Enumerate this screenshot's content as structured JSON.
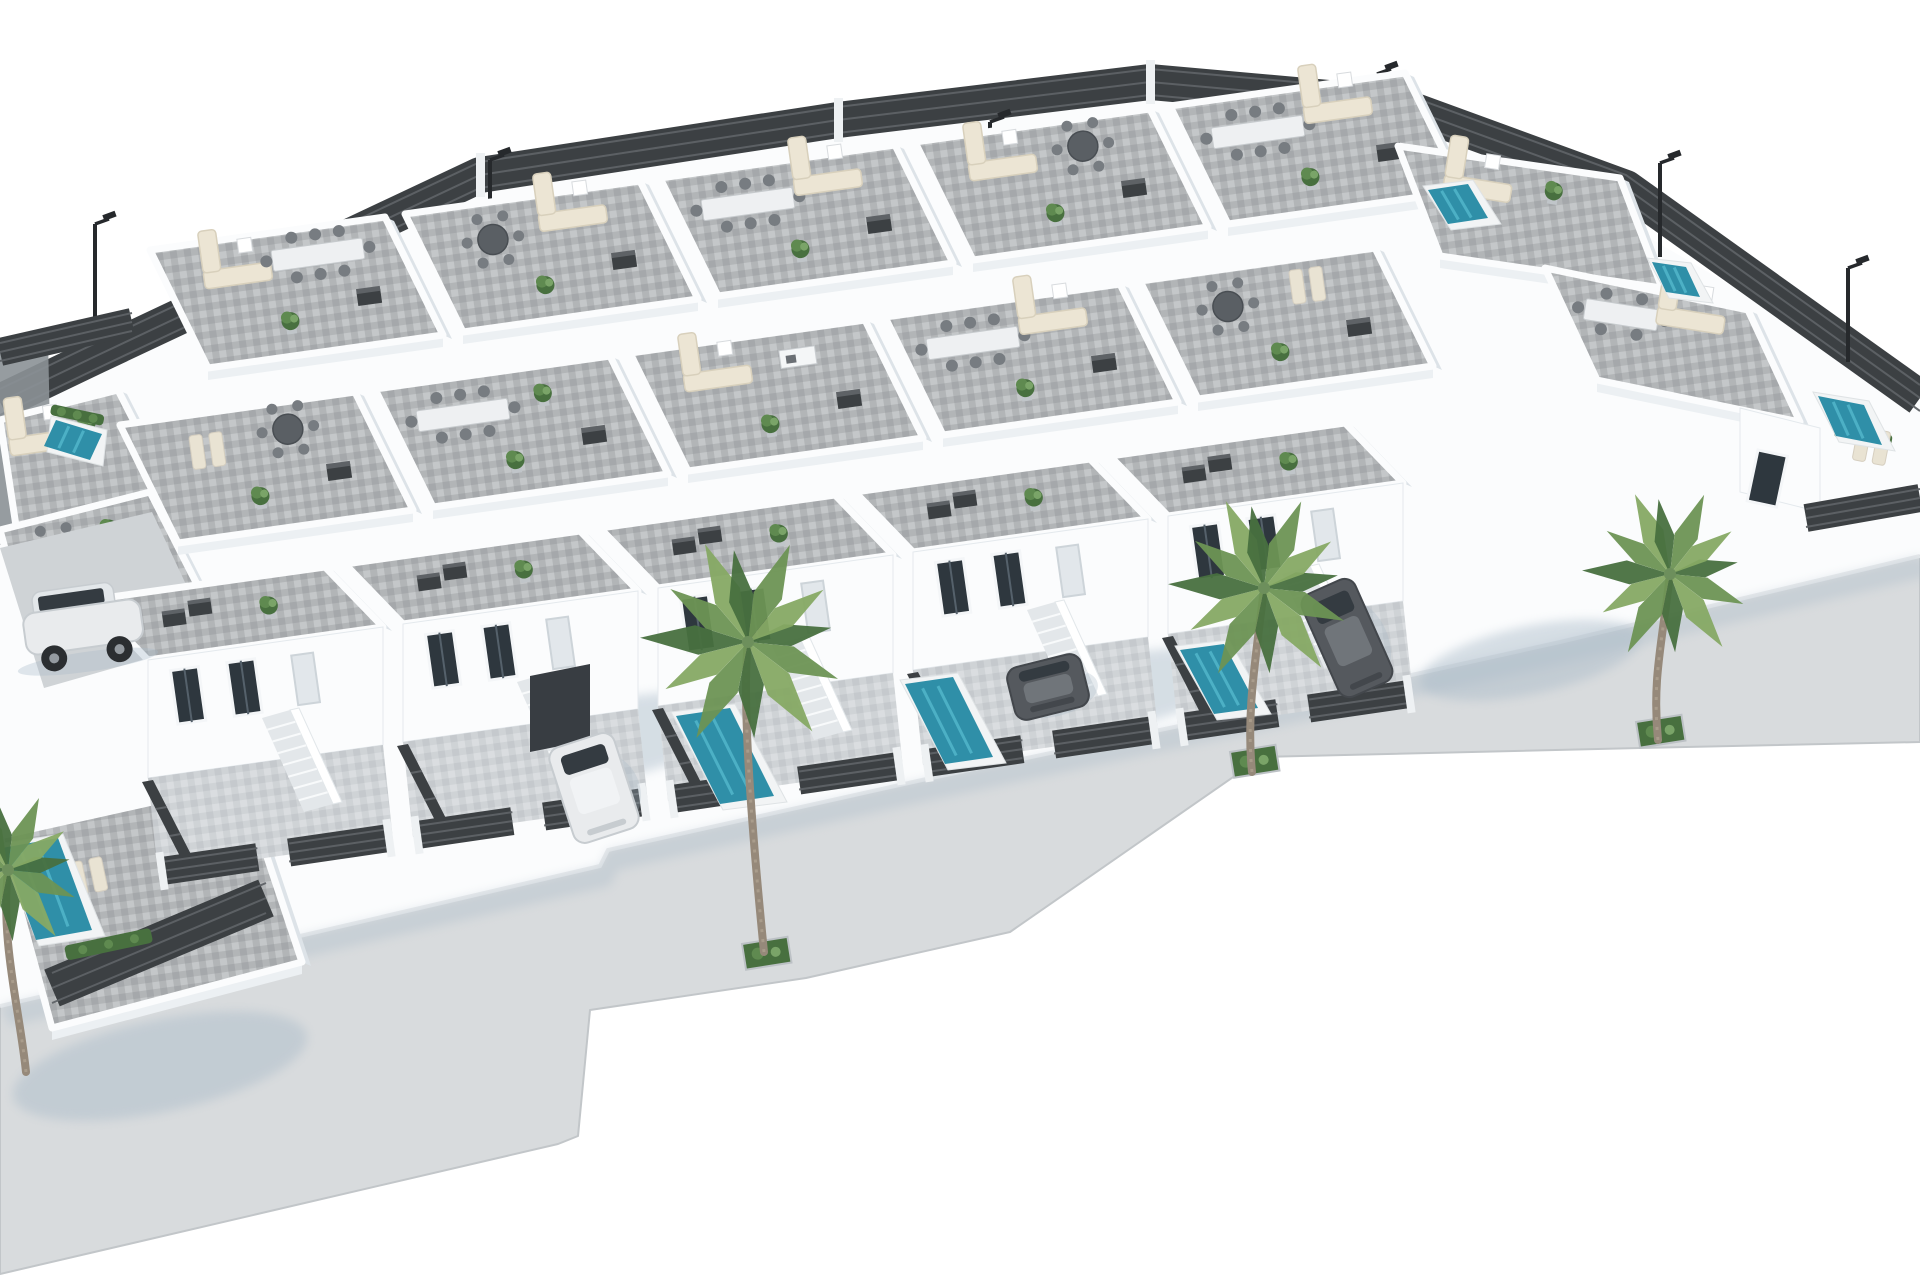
{
  "meta": {
    "description": "Aerial 3D architectural rendering of a modern white villa development: rows of flat-roof townhouse villas with grey tiled rooftop terraces furnished with sofas and dining sets, private front yards with small teal swimming pools, dark slatted perimeter fences, street lamps, parked cars and palm trees along a light grey sidewalk on white ground."
  },
  "palette": {
    "bg": "#ffffff",
    "wall": "#fbfcfd",
    "wall_shade": "#ecf0f3",
    "wall_shade2": "#dde3e8",
    "wall_dark": "#8b9196",
    "roof_base": "#b2b5b7",
    "roof_light": "#c4c7c9",
    "roof_dark": "#a0a3a5",
    "pavement": "#d8dbdd",
    "pavement_dark": "#cfd3d6",
    "curb": "#c2c6c9",
    "yard": "#cfd3d6",
    "yard_light": "#dde0e3",
    "fence": "#3c4043",
    "fence_slat": "#5e6266",
    "fence_post": "#eef1f3",
    "pool_rim": "#f2f4f5",
    "water": "#2f8fa8",
    "water_light": "#52b6cb",
    "plant_dark": "#48703f",
    "plant": "#5f8a50",
    "plant_light": "#7aa468",
    "palm_1": "#6d9454",
    "palm_2": "#86a964",
    "palm_trunk": "#96897a",
    "lounger": "#e9e3d3",
    "sofa": "#ece5d4",
    "sofa_edge": "#d8d0bc",
    "table_white": "#eef0f2",
    "table_dark": "#5a5f64",
    "chair": "#777c81",
    "car_white": "#e9ebed",
    "car_dark": "#55595e",
    "car_glass": "#343b41",
    "shadow": "#a9bac8",
    "lamp": "#26292c"
  },
  "scene": {
    "canvas": {
      "w": 1920,
      "h": 1280
    },
    "hull": [
      [
        0,
        420
      ],
      [
        96,
        350
      ],
      [
        480,
        168
      ],
      [
        1150,
        70
      ],
      [
        1400,
        92
      ],
      [
        1920,
        396
      ],
      [
        1920,
        560
      ],
      [
        1560,
        648
      ],
      [
        1236,
        722
      ],
      [
        922,
        782
      ],
      [
        600,
        864
      ],
      [
        0,
        1006
      ]
    ],
    "sidewalk": {
      "outline": [
        [
          0,
          1006
        ],
        [
          600,
          866
        ],
        [
          608,
          850
        ],
        [
          922,
          780
        ],
        [
          1236,
          714
        ],
        [
          1560,
          642
        ],
        [
          1920,
          556
        ],
        [
          1920,
          742
        ],
        [
          1640,
          748
        ],
        [
          1262,
          757
        ],
        [
          1010,
          932
        ],
        [
          806,
          978
        ],
        [
          590,
          1010
        ],
        [
          578,
          1136
        ],
        [
          558,
          1144
        ],
        [
          0,
          1274
        ]
      ],
      "upper_edge": [
        [
          0,
          1006
        ],
        [
          600,
          866
        ],
        [
          608,
          850
        ],
        [
          922,
          780
        ],
        [
          1236,
          714
        ],
        [
          1560,
          642
        ],
        [
          1920,
          556
        ]
      ]
    },
    "back_fence": {
      "points": [
        [
          0,
          402
        ],
        [
          96,
          356
        ],
        [
          480,
          175
        ],
        [
          838,
          120
        ],
        [
          1150,
          82
        ],
        [
          1396,
          104
        ],
        [
          1626,
          188
        ],
        [
          1920,
          398
        ]
      ],
      "width": 36,
      "posts": [
        [
          480,
          175
        ],
        [
          838,
          120
        ],
        [
          1150,
          82
        ],
        [
          1396,
          104
        ]
      ]
    },
    "grid": {
      "origin": [
        150,
        250
      ],
      "step_col": [
        255,
        -36
      ],
      "step_row": [
        -30,
        175
      ],
      "rows": 3,
      "cols": 5,
      "roof_a": [
        235,
        -33
      ],
      "roof_b": [
        58,
        118
      ],
      "roof_b_front": [
        58,
        60
      ],
      "facade_h": 118,
      "yard_d": 95
    },
    "roof_items": [
      [
        [
          "sofaL",
          "dining8",
          "plant",
          "ac"
        ],
        [
          "round6",
          "sofaL",
          "plant",
          "ac"
        ],
        [
          "dining8",
          "sofaL",
          "plant",
          "ac"
        ],
        [
          "sofaL",
          "round6",
          "plant",
          "ac"
        ],
        [
          "dining8",
          "sofaL",
          "plant",
          "ac"
        ]
      ],
      [
        [
          "loungers",
          "round6",
          "plant",
          "ac"
        ],
        [
          "dining8",
          "plant",
          "plant",
          "ac"
        ],
        [
          "sofaL",
          "kitchen",
          "plant",
          "ac"
        ],
        [
          "dining8",
          "sofaL",
          "plant",
          "ac"
        ],
        [
          "round6",
          "loungers",
          "plant",
          "ac"
        ]
      ]
    ],
    "front_roof_items": [
      "chimney",
      "plant"
    ],
    "left_wing": {
      "wall_strip": [
        [
          0,
          350
        ],
        [
          48,
          338
        ],
        [
          52,
          530
        ],
        [
          0,
          545
        ]
      ],
      "terraces": [
        {
          "quad": [
            [
              0,
              420
            ],
            [
              118,
              390
            ],
            [
              170,
              492
            ],
            [
              16,
              526
            ]
          ],
          "items": [
            "sofaL",
            "plant"
          ]
        },
        {
          "quad": [
            [
              0,
              530
            ],
            [
              150,
              492
            ],
            [
              204,
              598
            ],
            [
              30,
              640
            ]
          ],
          "items": [
            "round6",
            "plant"
          ]
        }
      ],
      "driveway": [
        [
          0,
          548
        ],
        [
          152,
          512
        ],
        [
          212,
          640
        ],
        [
          44,
          688
        ]
      ],
      "corner_terrace": {
        "quad": [
          [
            0,
            836
          ],
          [
            242,
            782
          ],
          [
            302,
            962
          ],
          [
            52,
            1028
          ]
        ],
        "items": [
          "loungers",
          "plant"
        ]
      },
      "fences": [
        {
          "pts": [
            [
              0,
              352
            ],
            [
              132,
              322
            ]
          ],
          "w": 28
        },
        {
          "pts": [
            [
              52,
              988
            ],
            [
              266,
              898
            ]
          ],
          "w": 40
        }
      ],
      "hedges": [
        [
          52,
          404,
          54,
          11,
          12
        ],
        [
          64,
          946,
          88,
          15,
          -12
        ]
      ]
    },
    "right_wing": {
      "roofs": [
        {
          "quad": [
            [
              1398,
              146
            ],
            [
              1620,
              178
            ],
            [
              1662,
              288
            ],
            [
              1440,
              256
            ]
          ],
          "items": [
            "sofaL",
            "plant"
          ]
        },
        {
          "quad": [
            [
              1545,
              268
            ],
            [
              1748,
              310
            ],
            [
              1800,
              422
            ],
            [
              1597,
              380
            ]
          ],
          "items": [
            "dining6",
            "sofaL"
          ]
        }
      ],
      "wall": [
        [
          1740,
          408
        ],
        [
          1820,
          428
        ],
        [
          1820,
          512
        ],
        [
          1740,
          492
        ]
      ],
      "door": [
        1758,
        450,
        30,
        52,
        12
      ],
      "front_fence": {
        "pts": [
          [
            1806,
            518
          ],
          [
            1920,
            498
          ]
        ],
        "w": 28
      },
      "hedges": [
        [
          1836,
          424,
          58,
          13,
          11
        ]
      ],
      "loungers": [
        1872,
        446,
        11
      ]
    },
    "pools": [
      {
        "q": [
          676,
          716
        ],
        "a": [
          54,
          -8
        ],
        "b": [
          44,
          88
        ]
      },
      {
        "q": [
          905,
          684
        ],
        "a": [
          48,
          -7
        ],
        "b": [
          40,
          80
        ]
      },
      {
        "q": [
          1180,
          650
        ],
        "a": [
          44,
          -6
        ],
        "b": [
          34,
          64
        ]
      },
      {
        "q": [
          1428,
          190
        ],
        "a": [
          40,
          -6
        ],
        "b": [
          20,
          34
        ]
      },
      {
        "q": [
          1652,
          262
        ],
        "a": [
          34,
          5
        ],
        "b": [
          14,
          30
        ]
      },
      {
        "q": [
          1818,
          396
        ],
        "a": [
          46,
          9
        ],
        "b": [
          18,
          40
        ]
      },
      {
        "q": [
          56,
          420
        ],
        "a": [
          46,
          14
        ],
        "b": [
          -12,
          26
        ]
      },
      {
        "q": [
          2,
          848
        ],
        "a": [
          56,
          -10
        ],
        "b": [
          34,
          92
        ]
      }
    ],
    "garage": [
      [
        530,
        676
      ],
      [
        590,
        664
      ],
      [
        590,
        740
      ],
      [
        530,
        752
      ]
    ],
    "cars": [
      {
        "type": "suv",
        "color": "white",
        "x": 24,
        "y": 584,
        "w": 118,
        "h": 84,
        "rot": -8
      },
      {
        "type": "top",
        "color": "white",
        "x": 560,
        "y": 738,
        "w": 68,
        "h": 100,
        "rot": -18
      },
      {
        "type": "top",
        "color": "dark",
        "x": 1010,
        "y": 660,
        "w": 76,
        "h": 54,
        "rot": -14
      },
      {
        "type": "top",
        "color": "dark",
        "x": 1318,
        "y": 582,
        "w": 58,
        "h": 112,
        "rot": -24
      }
    ],
    "palms": [
      {
        "crown": [
          748,
          642
        ],
        "r": 108,
        "base": [
          764,
          952
        ]
      },
      {
        "crown": [
          1264,
          588
        ],
        "r": 96,
        "base": [
          1252,
          772
        ]
      },
      {
        "crown": [
          1670,
          574
        ],
        "r": 88,
        "base": [
          1658,
          740
        ]
      },
      {
        "crown": [
          8,
          870
        ],
        "r": 80,
        "base": [
          26,
          1072
        ]
      }
    ],
    "planters": [
      [
        742,
        944
      ],
      [
        1230,
        752
      ],
      [
        1636,
        722
      ]
    ],
    "shadows": [
      {
        "c": [
          600,
          742
        ],
        "rx": 148,
        "ry": 40,
        "rot": -12
      },
      {
        "c": [
          1118,
          692
        ],
        "rx": 126,
        "ry": 36,
        "rot": -12
      },
      {
        "c": [
          1530,
          660
        ],
        "rx": 112,
        "ry": 34,
        "rot": -12
      },
      {
        "c": [
          160,
          1066
        ],
        "rx": 150,
        "ry": 46,
        "rot": -12
      }
    ],
    "lamps": [
      [
        95,
        224
      ],
      [
        490,
        160
      ],
      [
        990,
        122
      ],
      [
        1377,
        74
      ],
      [
        1660,
        163
      ],
      [
        1848,
        268
      ]
    ]
  }
}
